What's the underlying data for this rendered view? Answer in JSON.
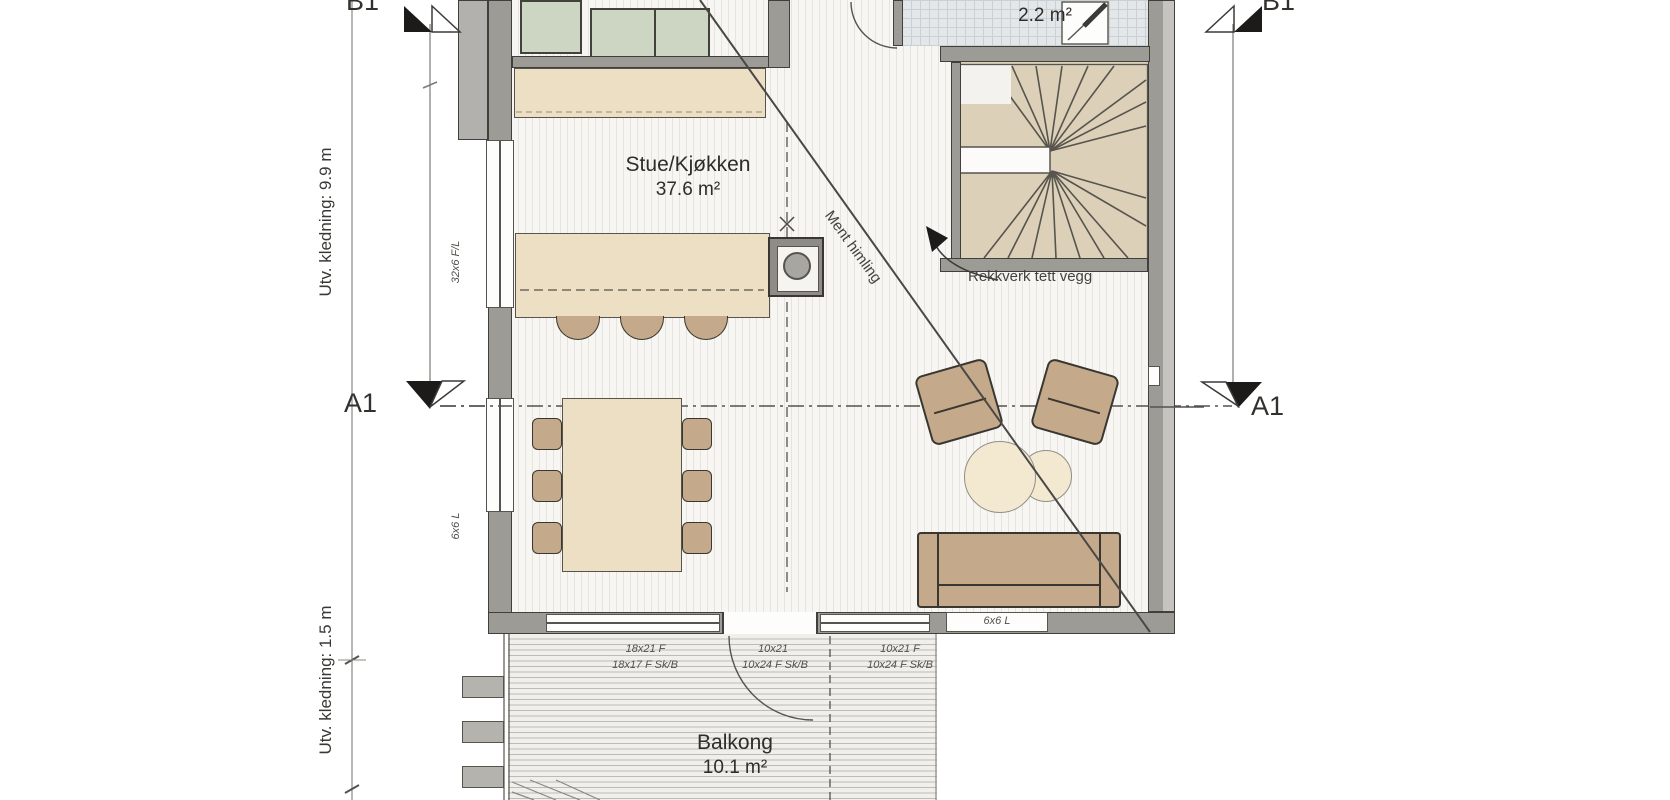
{
  "plan": {
    "labels": {
      "b1": "B1",
      "a1": "A1"
    },
    "rooms": {
      "living": {
        "name": "Stue/Kjøkken",
        "area": "37.6 m²"
      },
      "wc": {
        "name": "WC",
        "area": "2.2 m²"
      },
      "balcony": {
        "name": "Balkong",
        "area": "10.1 m²"
      }
    },
    "annotations": {
      "railing_note": "Rekkverk tett vegg",
      "ceiling_note": "Ment himling"
    },
    "dimensions": {
      "cladding_upper": "Utv. kledning: 9.9 m",
      "cladding_lower": "Utv. kledning: 1.5 m"
    },
    "openings": {
      "left_wall_upper": "32x6 F/L",
      "left_wall_lower": "6x6 L",
      "bottom_wall_right": "6x6 L",
      "bottom_row_1": [
        "18x21 F",
        "10x21",
        "10x21 F"
      ],
      "bottom_row_2": [
        "18x17 F Sk/B",
        "10x24 F Sk/B",
        "10x24 F Sk/B"
      ]
    },
    "colors": {
      "wall": "#9c9b96",
      "wood": "#ecdfc3",
      "furniture_tan": "#c4aa8a",
      "cabinet_green": "#ccd6c2",
      "wc_tile": "#e3e7e9",
      "line_dark": "#4a4846"
    }
  }
}
